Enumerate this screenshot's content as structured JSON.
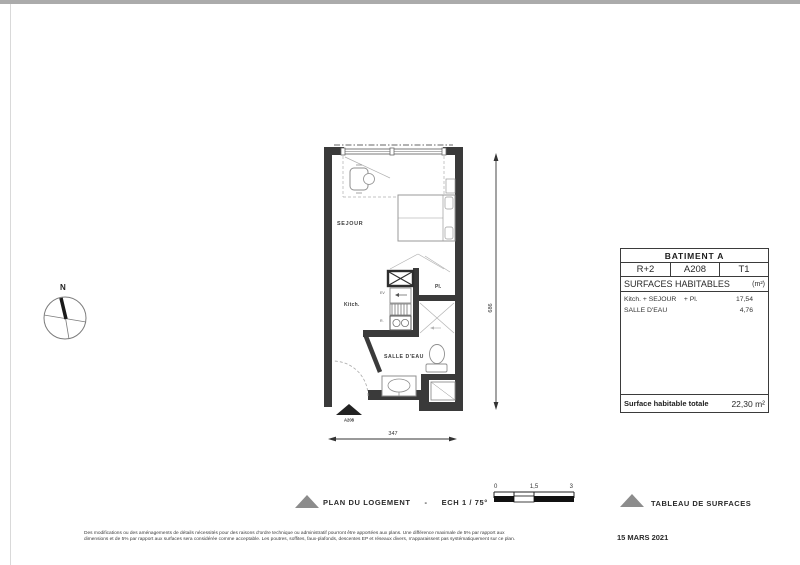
{
  "page": {
    "date": "15 MARS 2021",
    "disclaimer_line1": "Des modifications ou des aménagements de détails nécessités pour des raisons d'ordre technique ou administratif pourront être apportées aux plans. Une différence maximale de 5% par rapport aux",
    "disclaimer_line2": "dimensions et de 5% par rapport aux surfaces sera considérée comme acceptable. Les poutres, soffites, faux-plafonds, descentes EP et réseaux divers, n'apparaissent pas systématiquement sur ce plan."
  },
  "plan": {
    "rooms": {
      "sejour": "SEJOUR",
      "kitchen": "Kitch.",
      "bathroom": "SALLE D'EAU",
      "closet": "Pl."
    },
    "fixtures": {
      "sink": "EV",
      "fridge": "R."
    },
    "unit_marker": "A208",
    "dimensions": {
      "height_cm": "686",
      "width_cm": "347"
    },
    "compass": {
      "north": "N"
    }
  },
  "legend": {
    "plan_label": "PLAN  DU LOGEMENT",
    "separator": "-",
    "scale_label": "ECH  1 / 75°",
    "table_label": "TABLEAU DE SURFACES",
    "scale_bar": {
      "start": "0",
      "mid": "1,5",
      "end": "3"
    }
  },
  "surface_table": {
    "building": "BATIMENT A",
    "floor": "R+2",
    "unit": "A208",
    "type": "T1",
    "section_title": "SURFACES HABITABLES",
    "section_unit": "(m²)",
    "rows": [
      {
        "label": "Kitch. + SEJOUR    + Pl.",
        "value": "17,54"
      },
      {
        "label": "SALLE D'EAU",
        "value": "4,76"
      }
    ],
    "total_label": "Surface habitable totale",
    "total_value": "22,30 m²"
  },
  "colors": {
    "wall": "#3a3a3a",
    "furniture": "#9a9a9a",
    "accent_gray": "#8c8c8c"
  }
}
